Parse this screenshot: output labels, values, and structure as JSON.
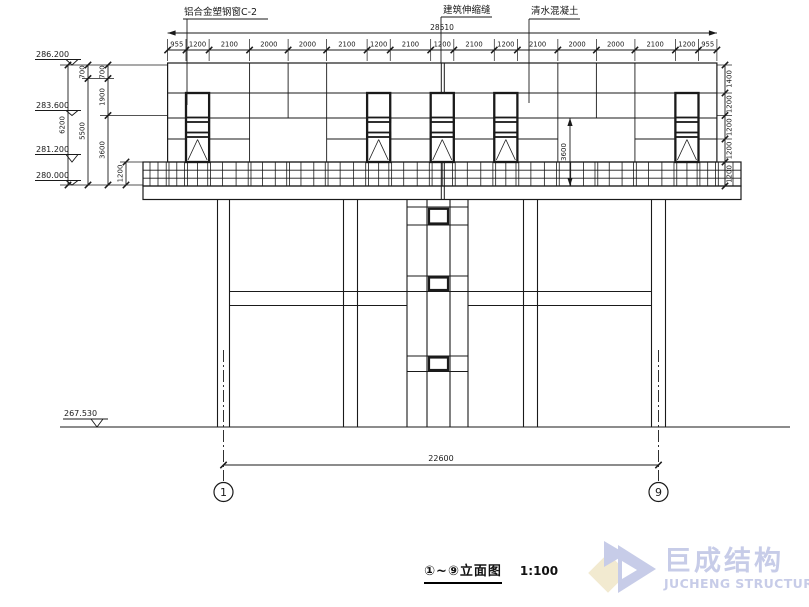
{
  "colors": {
    "ink": "#1a1a1a",
    "logo_blue": "#c7cce8",
    "logo_yellow": "#f2ead0"
  },
  "top_labels": {
    "window": "铝合金塑钢窗C-2",
    "joint": "建筑伸缩缝",
    "concrete": "清水混凝土"
  },
  "dim_top": {
    "total": "28510",
    "segments": [
      "955",
      "1200",
      "2100",
      "2000",
      "2000",
      "2100",
      "1200",
      "2100",
      "1200",
      "2100",
      "1200",
      "2100",
      "2000",
      "2000",
      "2100",
      "1200",
      "955"
    ]
  },
  "dim_left": {
    "overall": "6200",
    "chain2": [
      "700",
      "5500"
    ],
    "chain3": [
      "700",
      "1900",
      "3600"
    ],
    "walkway": "1200"
  },
  "dim_right": [
    "1400",
    "1200",
    "1200",
    "1200",
    "1200"
  ],
  "dim_inner": "3600",
  "elevations": {
    "top": "286.200",
    "mid": "283.600",
    "low": "281.200",
    "base": "280.000",
    "ground": "267.530"
  },
  "dim_bottom": "22600",
  "axes": {
    "left": "1",
    "right": "9"
  },
  "caption": {
    "title": "①~⑨立面图",
    "scale": "1:100"
  },
  "logo": {
    "cn": "巨成结构",
    "en": "JUCHENG STRUCTURE"
  }
}
